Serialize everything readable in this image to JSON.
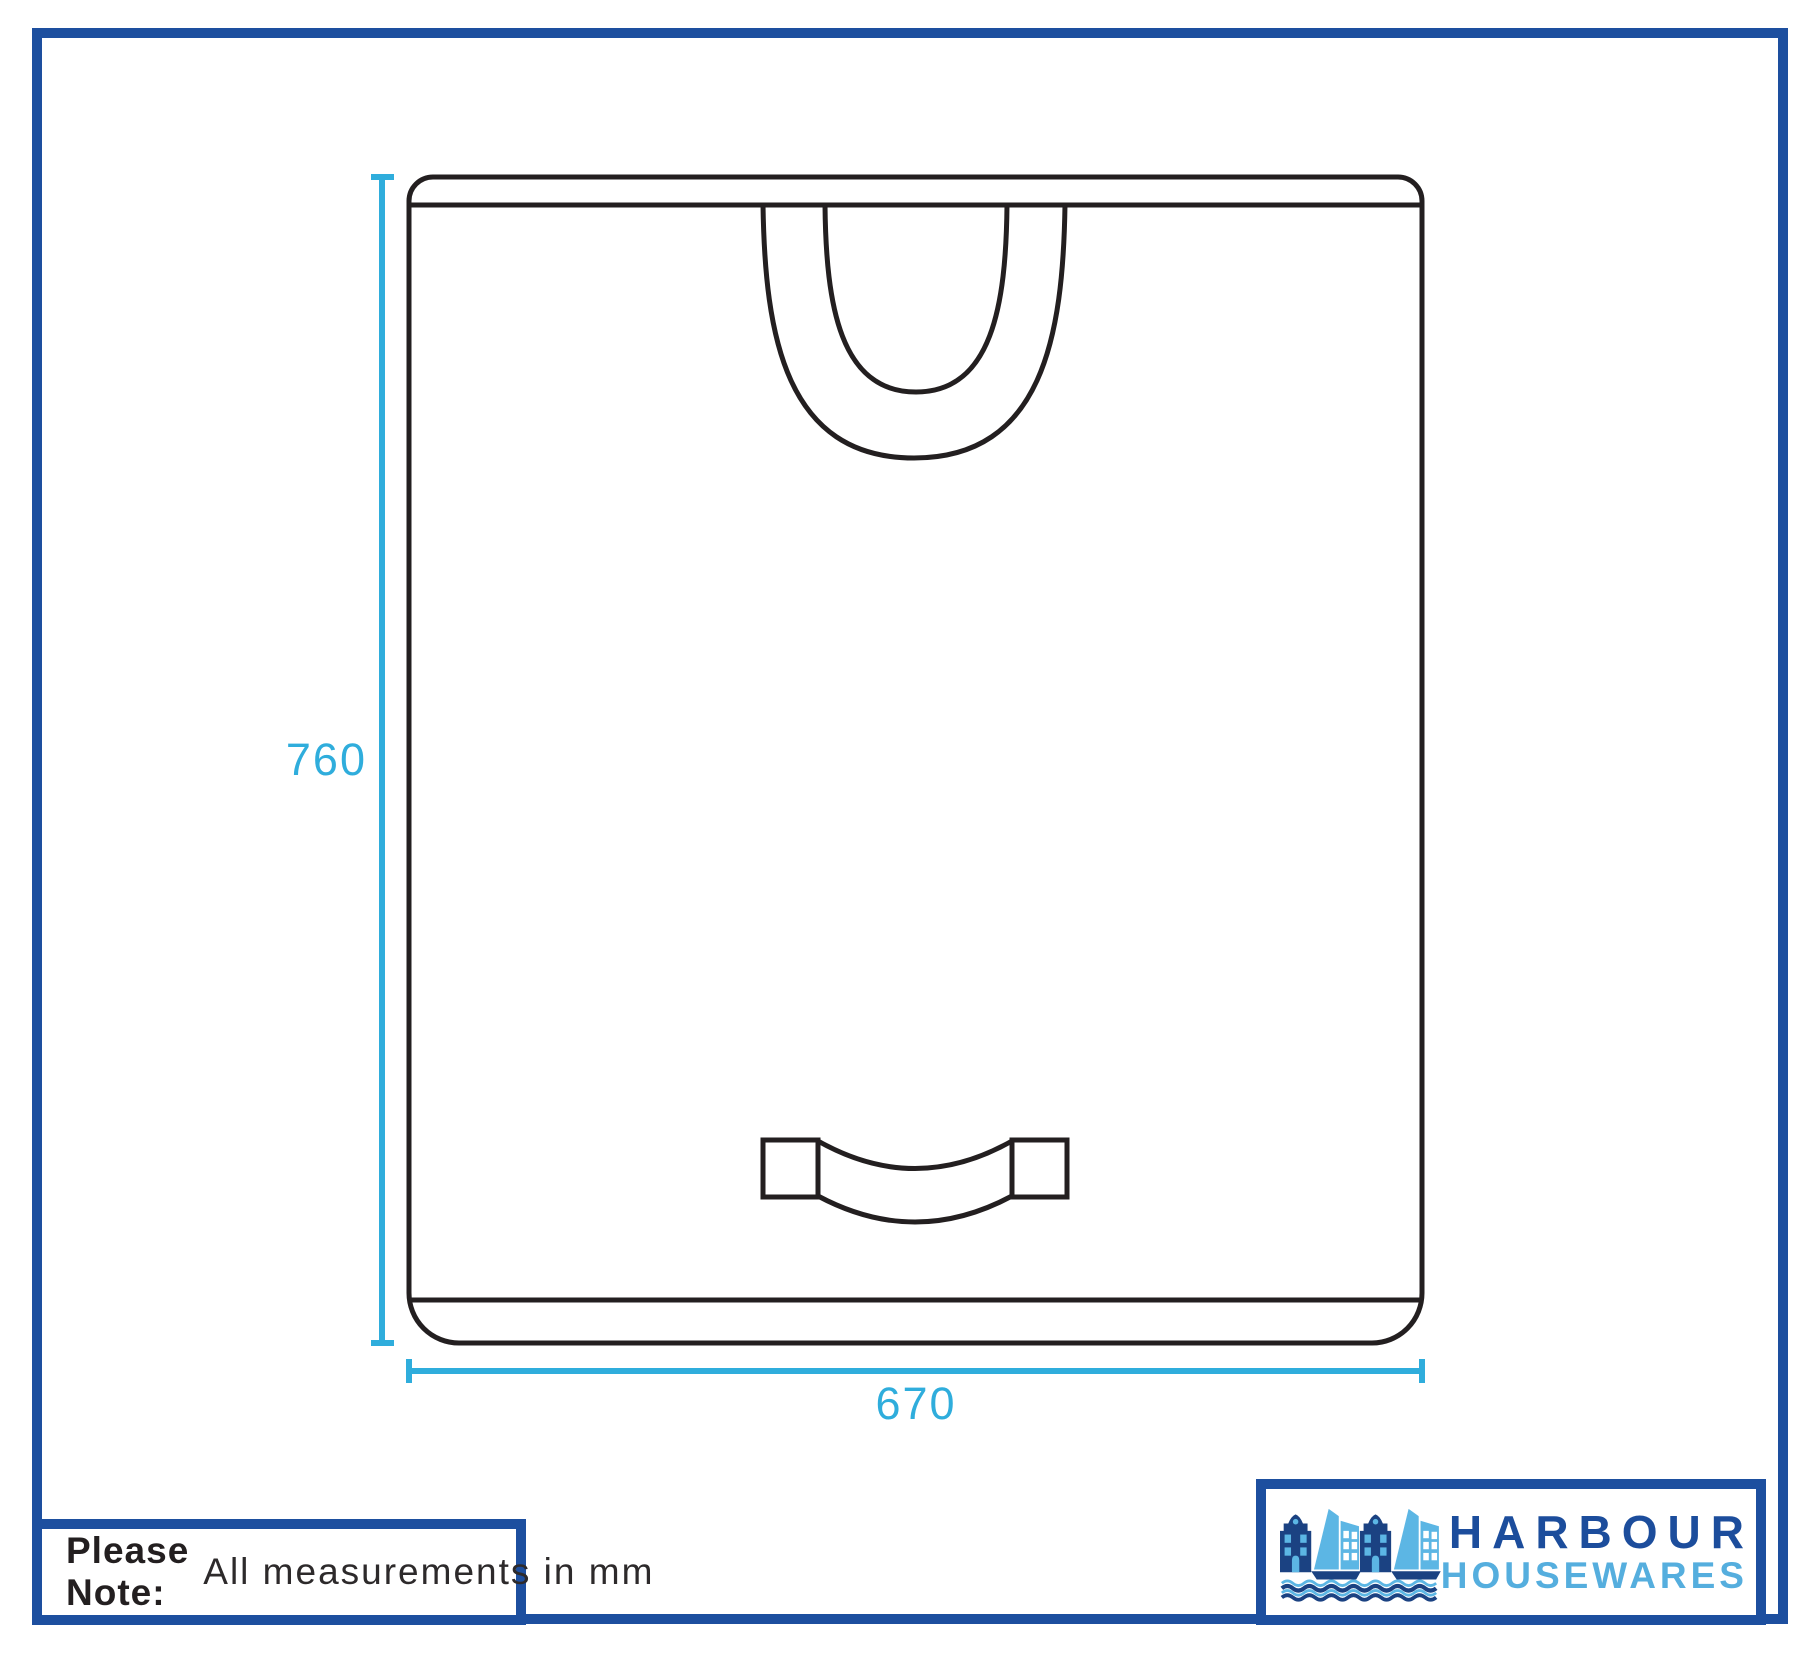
{
  "drawing": {
    "height_dim": "760",
    "width_dim": "670"
  },
  "note": {
    "bold": "Please Note:",
    "text": "All measurements in mm"
  },
  "logo": {
    "name_line1": "HARBOUR",
    "name_line2": "HOUSEWARES"
  },
  "colors": {
    "dimension_cyan": "#2FADDC",
    "brand_navy": "#1D4F9F",
    "harbour_text_navy": "#1C4D9C",
    "housewares_text_blue": "#55AEDE",
    "icon_navy": "#1B4282",
    "icon_light_blue": "#5CB6E4",
    "drawing_line_dark": "#231F20"
  }
}
